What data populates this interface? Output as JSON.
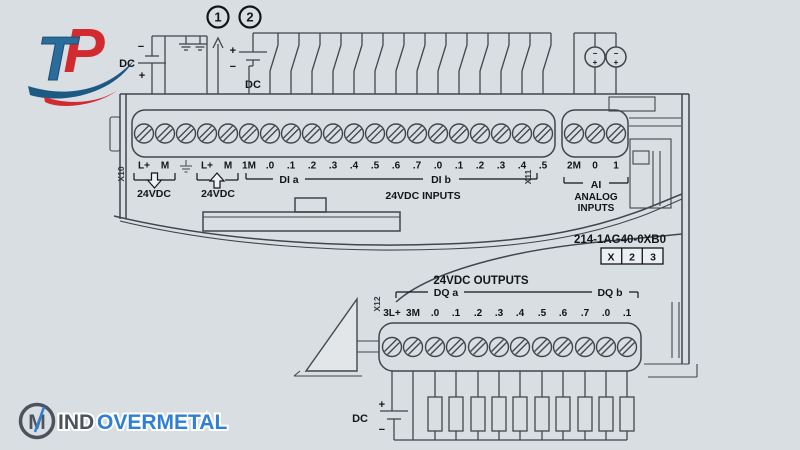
{
  "branding": {
    "tp_logo": {
      "letter_t": "T",
      "letter_p": "P"
    },
    "footer_logo": {
      "monogram": "M",
      "part1": "IND",
      "part2": "OVERMETAL"
    }
  },
  "colors": {
    "background": "#d9dee2",
    "line": "#41464c",
    "tp_blue": "#2a6d9c",
    "tp_red": "#d22b2f",
    "tp_navy": "#1d5a83",
    "footer_dark": "#4d525c",
    "footer_blue": "#2f7fd4"
  },
  "callouts": {
    "note1": "1",
    "note2": "2"
  },
  "power": {
    "dc_supply_left": {
      "label": "DC",
      "minus": "−",
      "plus": "+"
    },
    "dc_inputs_source": {
      "label": "DC",
      "minus": "−",
      "plus": "+"
    },
    "dc_outputs_source": {
      "label": "DC",
      "minus": "−",
      "plus": "+"
    },
    "analog_source_minus": "−",
    "analog_source_plus": "+"
  },
  "module": {
    "article_number": "214-1AG40-0XB0",
    "order_box": [
      "X",
      "2",
      "3"
    ],
    "connectors": {
      "x10": {
        "name": "X10",
        "labels": [
          "L+",
          "M",
          "",
          "L+",
          "M",
          "1M",
          ".0",
          ".1",
          ".2",
          ".3",
          ".4",
          ".5",
          ".6",
          ".7",
          ".0",
          ".1",
          ".2",
          ".3",
          ".4",
          ".5"
        ]
      },
      "x11": {
        "name": "X11",
        "labels": [
          "2M",
          "0",
          "1"
        ]
      },
      "x12": {
        "name": "X12",
        "labels": [
          "3L+",
          "3M",
          ".0",
          ".1",
          ".2",
          ".3",
          ".4",
          ".5",
          ".6",
          ".7",
          ".0",
          ".1"
        ]
      }
    },
    "groups": {
      "sensor_supply": "24VDC",
      "power_supply": "24VDC",
      "di_a": "DI a",
      "di_b": "DI b",
      "inputs_title": "24VDC INPUTS",
      "ai": "AI",
      "analog_line1": "ANALOG",
      "analog_line2": "INPUTS",
      "outputs_title": "24VDC OUTPUTS",
      "dq_a": "DQ a",
      "dq_b": "DQ b"
    }
  }
}
